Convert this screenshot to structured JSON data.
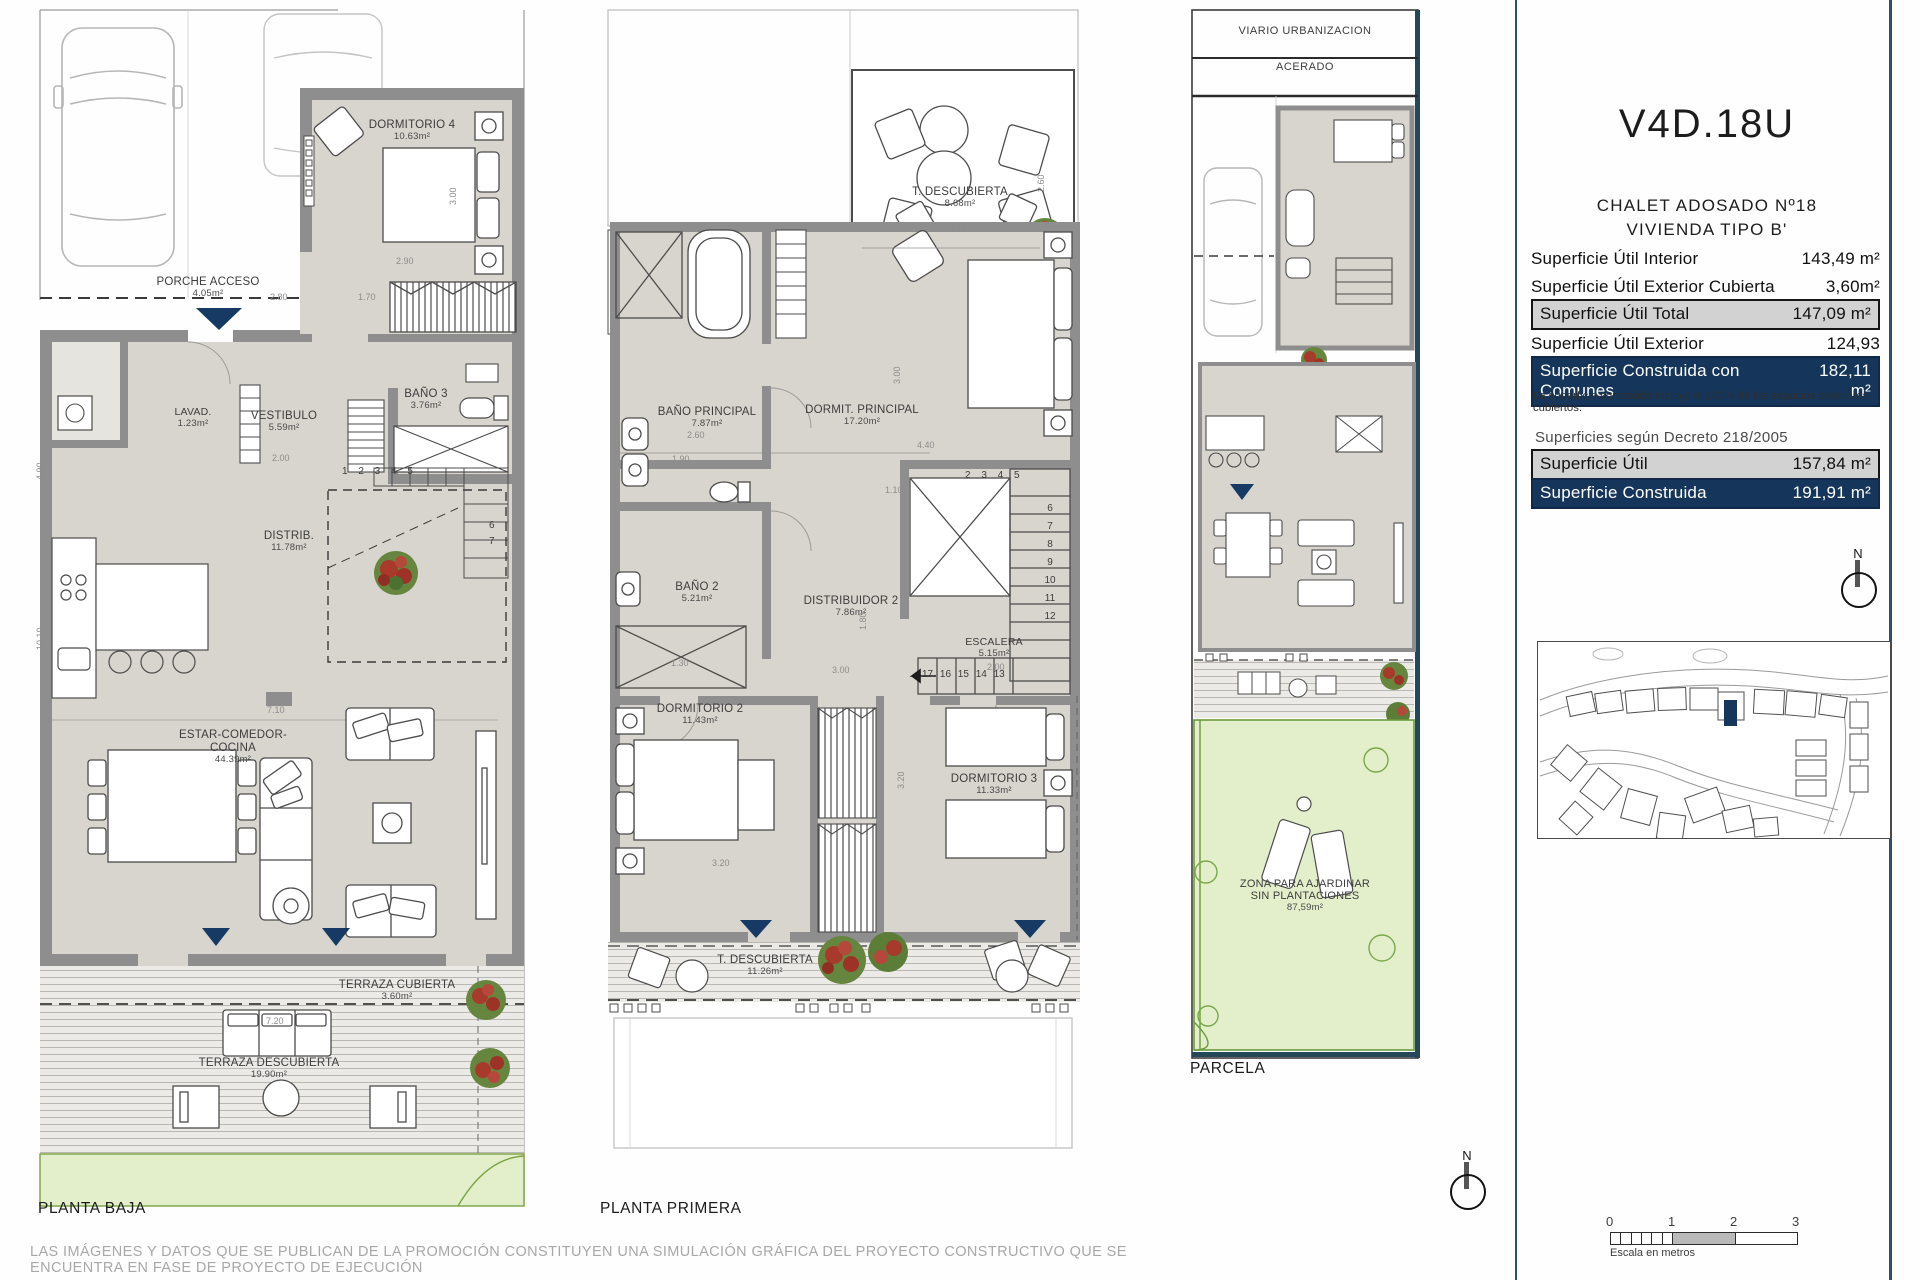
{
  "info_panel": {
    "title": "V4D.18U",
    "subtitle_line1": "CHALET ADOSADO Nº18",
    "subtitle_line2": "VIVIENDA TIPO B'",
    "surface_rows": [
      {
        "label": "Superficie Útil Interior",
        "value": "143,49 m²"
      },
      {
        "label": "Superficie Útil Exterior Cubierta",
        "value": "3,60m²"
      },
      {
        "label": "Superficie Útil Total",
        "value": "147,09 m²"
      },
      {
        "label": "Superficie Útil Exterior Descubierta",
        "value": "124,93 m²"
      },
      {
        "label": "Superficie Construida con Comunes",
        "value": "182,11 m²"
      }
    ],
    "note": "La superficie construida incluye el 100% de los espacios exteriores cubiertos.",
    "decreto_heading": "Superficies según Decreto 218/2005",
    "decreto_rows": [
      {
        "label": "Superficie Útil",
        "value": "157,84 m²"
      },
      {
        "label": "Superficie Construida",
        "value": "191,91 m²"
      }
    ],
    "north_label": "N",
    "scale_bar": {
      "ticks": [
        "0",
        "1",
        "2",
        "3"
      ],
      "caption": "Escala en metros"
    }
  },
  "plans": {
    "baja": {
      "title": "PLANTA BAJA",
      "rooms": {
        "dormitorio4": {
          "name": "DORMITORIO 4",
          "area": "10.63m²"
        },
        "porche": {
          "name": "PORCHE ACCESO",
          "area": "4.05m²"
        },
        "lavadero": {
          "name": "LAVAD.",
          "area": "1.23m²"
        },
        "vestibulo": {
          "name": "VESTIBULO",
          "area": "5.59m²"
        },
        "bano3": {
          "name": "BAÑO 3",
          "area": "3.76m²"
        },
        "distribuidor": {
          "name": "DISTRIB.",
          "area": "11.78m²"
        },
        "estar": {
          "name": "ESTAR-COMEDOR-COCINA",
          "area": "44.39m²"
        },
        "terraza_cubierta": {
          "name": "TERRAZA CUBIERTA",
          "area": "3.60m²"
        },
        "terraza_descubierta": {
          "name": "TERRAZA DESCUBIERTA",
          "area": "19.90m²"
        }
      },
      "stairs": {
        "row1": "1 2 3 4 5",
        "col1": "6\n7"
      },
      "dims": [
        "2.90",
        "3.00",
        "2.80",
        "1.70",
        "2.00",
        "7.10",
        "7.20",
        "4.90",
        "10.10"
      ]
    },
    "primera": {
      "title": "PLANTA PRIMERA",
      "rooms": {
        "t_descubierta_top": {
          "name": "T. DESCUBIERTA",
          "area": "8.68m²"
        },
        "bano_principal": {
          "name": "BAÑO PRINCIPAL",
          "area": "7.87m²"
        },
        "dormit_principal": {
          "name": "DORMIT. PRINCIPAL",
          "area": "17.20m²"
        },
        "bano2": {
          "name": "BAÑO 2",
          "area": "5.21m²"
        },
        "distribuidor2": {
          "name": "DISTRIBUIDOR 2",
          "area": "7.86m²"
        },
        "escalera": {
          "name": "ESCALERA",
          "area": "5.15m²"
        },
        "dormitorio2": {
          "name": "DORMITORIO 2",
          "area": "11.43m²"
        },
        "dormitorio3": {
          "name": "DORMITORIO 3",
          "area": "11.33m²"
        },
        "t_descubierta_bottom": {
          "name": "T. DESCUBIERTA",
          "area": "11.26m²"
        }
      },
      "stairs": {
        "row_top": "2 3 4 5",
        "col_right": "6\n7\n8\n9\n10\n11\n12",
        "row_bottom": "17 16 15 14 13"
      },
      "dims": [
        "3.20",
        "2.60",
        "3.00",
        "4.40",
        "2.60",
        "1.90",
        "1.10",
        "1.30",
        "3.00",
        "1.80",
        "2.00",
        "3.20",
        "3.20"
      ]
    },
    "parcela": {
      "title": "PARCELA",
      "labels": {
        "viario": "VIARIO URBANIZACION",
        "acerado": "ACERADO",
        "zona_line1": "ZONA PARA AJARDINAR",
        "zona_line2": "SIN PLANTACIONES",
        "zona_area": "87,59m²"
      }
    }
  },
  "footer": {
    "disclaimer": "LAS IMÁGENES Y DATOS QUE SE PUBLICAN DE LA PROMOCIÓN CONSTITUYEN UNA SIMULACIÓN GRÁFICA DEL PROYECTO CONSTRUCTIVO QUE SE ENCUENTRA EN FASE DE PROYECTO DE EJECUCIÓN"
  }
}
